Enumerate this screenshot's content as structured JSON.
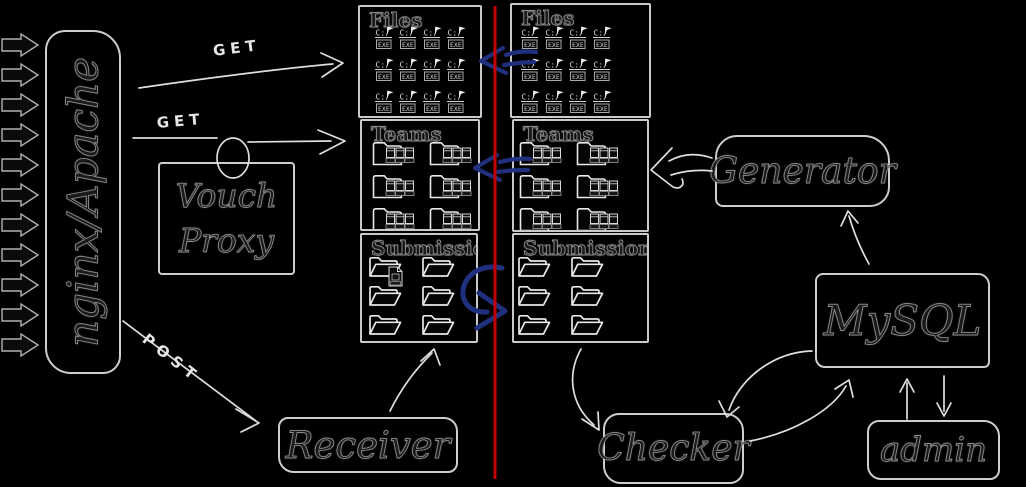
{
  "colors": {
    "background": "#000000",
    "divider": "#c40000",
    "sync_arrow": "#20307f",
    "stroke": "#dedede"
  },
  "gateway": {
    "label": "nginx/Apache",
    "incoming_arrows": 11
  },
  "vouch_proxy": {
    "line1": "Vouch",
    "line2": "Proxy"
  },
  "requests": {
    "get_top": "GET",
    "get_bottom": "GET",
    "post": "POST"
  },
  "left_store": {
    "files": {
      "title": "Files",
      "icon_count": 12
    },
    "teams": {
      "title": "Teams",
      "icon_count": 6
    },
    "submissions": {
      "title": "Submissions",
      "icon_count": 6
    }
  },
  "right_store": {
    "files": {
      "title": "Files",
      "icon_count": 12
    },
    "teams": {
      "title": "Teams",
      "icon_count": 6
    },
    "submissions": {
      "title": "Submissions",
      "icon_count": 6
    }
  },
  "services": {
    "receiver": "Receiver",
    "generator": "Generator",
    "mysql": "MySQL",
    "checker": "Checker",
    "admin": "admin"
  },
  "icons": {
    "exe_drive": "C:/",
    "exe_label": "EXE"
  }
}
